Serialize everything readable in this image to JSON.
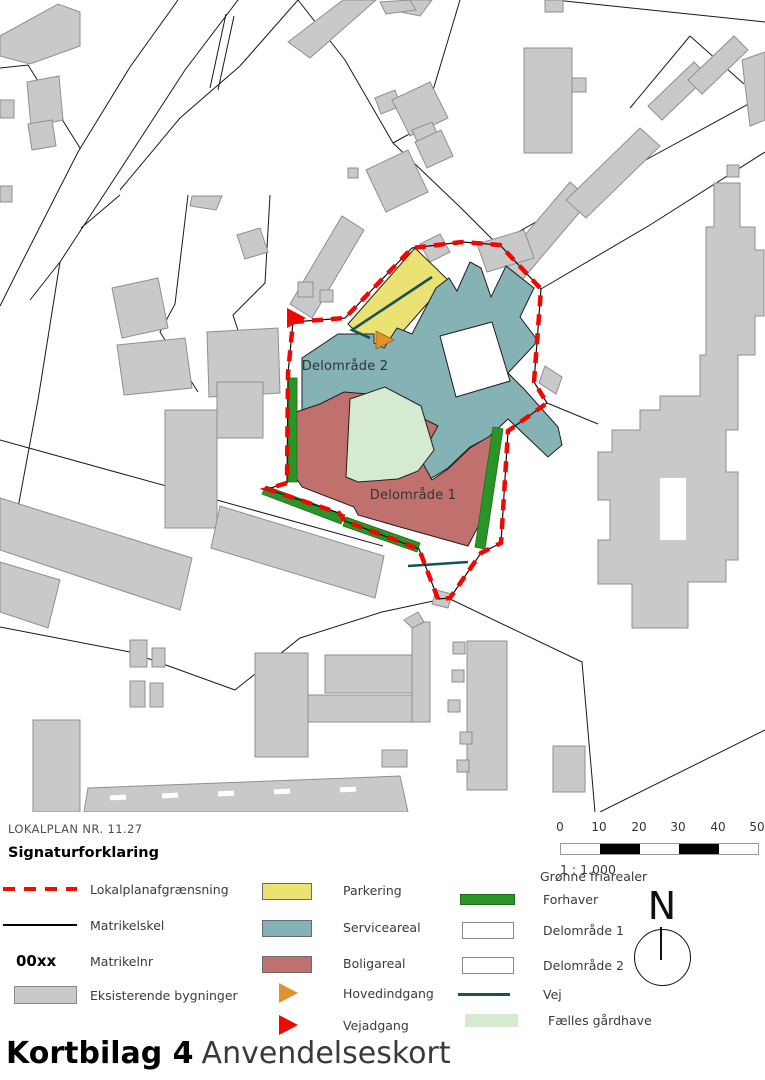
{
  "map": {
    "area_labels": [
      {
        "label": "Delområde 2"
      },
      {
        "label": "Delområde 1"
      }
    ]
  },
  "legend": {
    "plan_number": "LOKALPLAN NR. 11.27",
    "heading": "Signaturforklaring",
    "column1": [
      {
        "icon": "red-dashed-line",
        "label": "Lokalplanafgrænsning"
      },
      {
        "icon": "black-line",
        "label": "Matrikelskel"
      },
      {
        "icon": "text-sample",
        "sample": "00xx",
        "label": "Matrikelnr"
      },
      {
        "icon": "gray-rect",
        "label": "Eksisterende bygninger"
      }
    ],
    "column2": [
      {
        "icon": "yellow-rect",
        "label": "Parkering"
      },
      {
        "icon": "teal-rect",
        "label": "Serviceareal"
      },
      {
        "icon": "red-rect",
        "label": "Boligareal"
      },
      {
        "icon": "orange-triangle",
        "label": "Hovedindgang"
      },
      {
        "icon": "red-triangle",
        "label": "Vejadgang"
      }
    ],
    "column3": {
      "header": "Grønne friarealer",
      "items": [
        {
          "icon": "green-bar",
          "label": "Forhaver"
        },
        {
          "icon": "white-box",
          "label": "Delområde 1"
        },
        {
          "icon": "white-box",
          "label": "Delområde 2"
        },
        {
          "icon": "teal-line",
          "label": "Vej"
        },
        {
          "icon": "lightgreen-rect",
          "label": "Fælles gårdhave"
        }
      ]
    }
  },
  "scalebar": {
    "ticks": [
      "0",
      "10",
      "20",
      "30",
      "40",
      "50"
    ],
    "ratio": "1 : 1.000"
  },
  "north": {
    "letter": "N"
  },
  "title": {
    "bold": "Kortbilag 4",
    "regular": "Anvendelseskort"
  },
  "colors": {
    "plan_boundary_red": "#f50500",
    "parkering_yellow": "#ebe274",
    "serviceareal_teal": "#85b2b4",
    "boligareal_red": "#c1716d",
    "forhaver_green": "#2a9428",
    "faelles_gaardhave_green": "#d5ead0",
    "vej_teal": "#15525b",
    "hovedindgang_orange": "#e0922f",
    "building_gray": "#c9c9c9"
  }
}
